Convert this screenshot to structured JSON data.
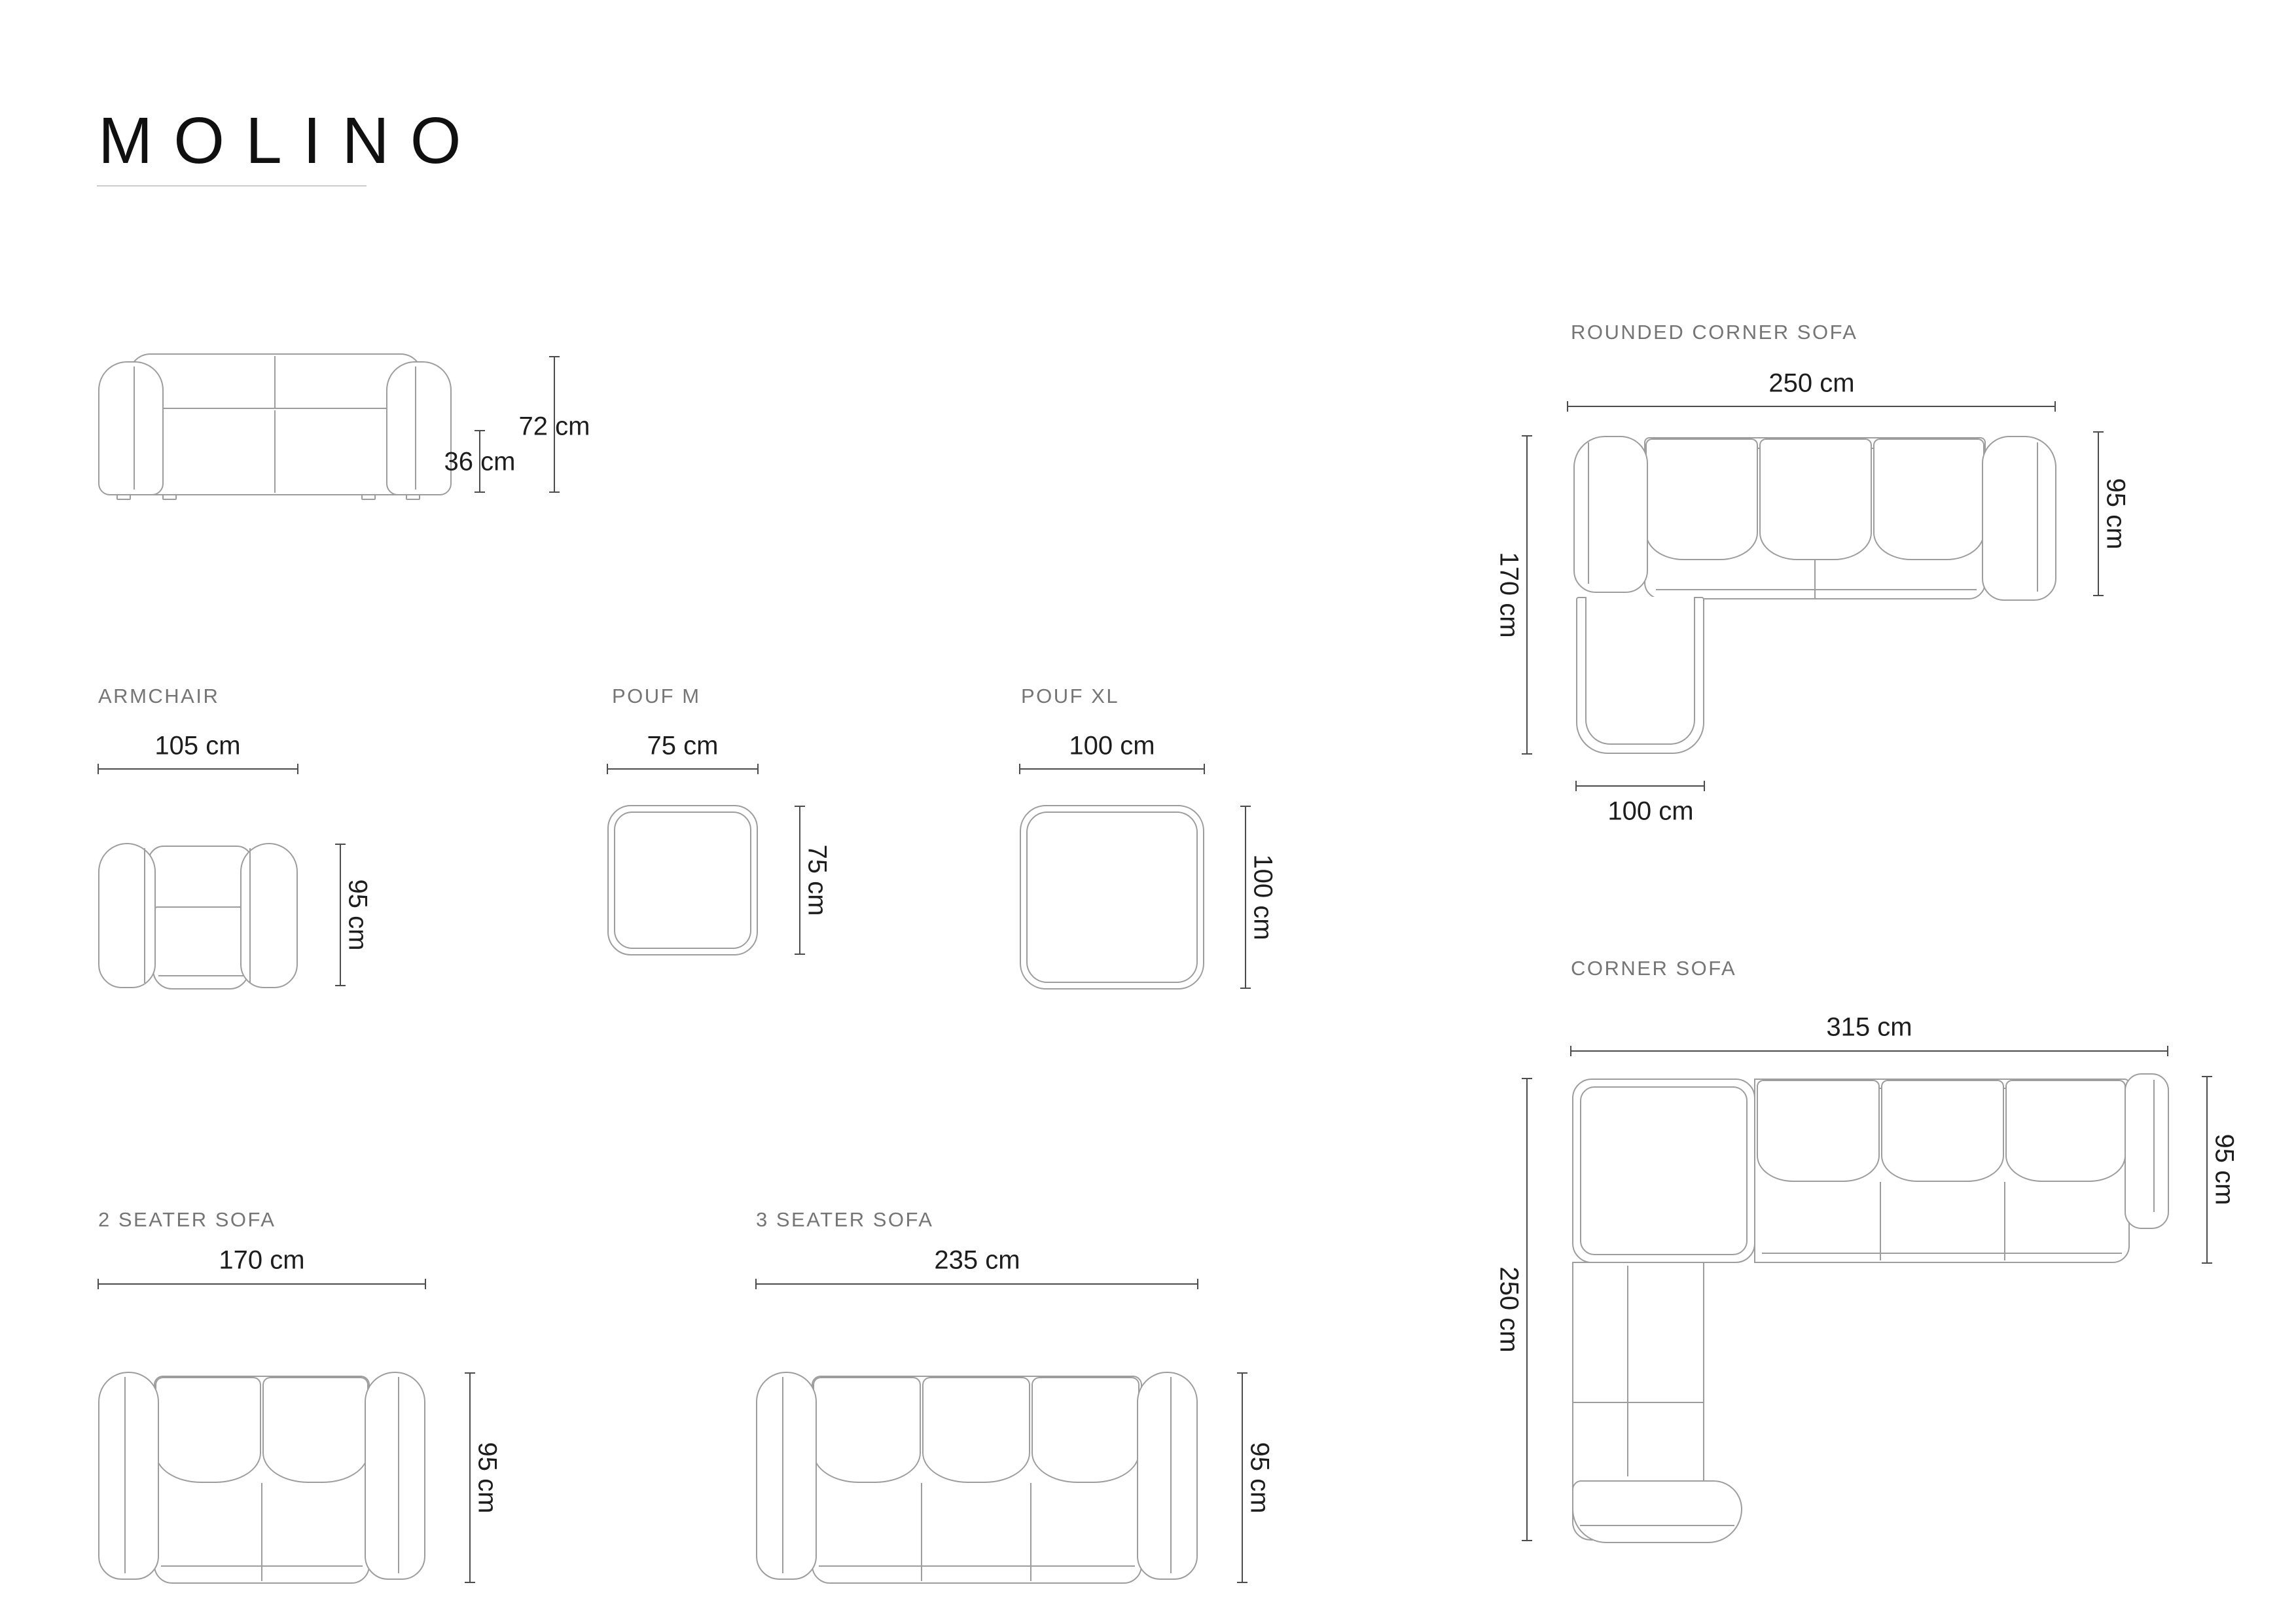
{
  "title": "MOLINO",
  "sections": {
    "front_view": {
      "total_height": "72 cm",
      "seat_height": "36 cm"
    },
    "rounded_corner_sofa": {
      "label": "ROUNDED CORNER SOFA",
      "width": "250 cm",
      "depth": "95 cm",
      "side_length": "170 cm",
      "chaise_width": "100 cm"
    },
    "armchair": {
      "label": "ARMCHAIR",
      "width": "105 cm",
      "depth": "95 cm"
    },
    "pouf_m": {
      "label": "POUF M",
      "width": "75 cm",
      "depth": "75 cm"
    },
    "pouf_xl": {
      "label": "POUF XL",
      "width": "100 cm",
      "depth": "100 cm"
    },
    "two_seater_sofa": {
      "label": "2 SEATER SOFA",
      "width": "170 cm",
      "depth": "95 cm"
    },
    "three_seater_sofa": {
      "label": "3 SEATER SOFA",
      "width": "235 cm",
      "depth": "95 cm"
    },
    "corner_sofa": {
      "label": "CORNER SOFA",
      "width": "315 cm",
      "depth": "95 cm",
      "side_length": "250 cm"
    }
  }
}
